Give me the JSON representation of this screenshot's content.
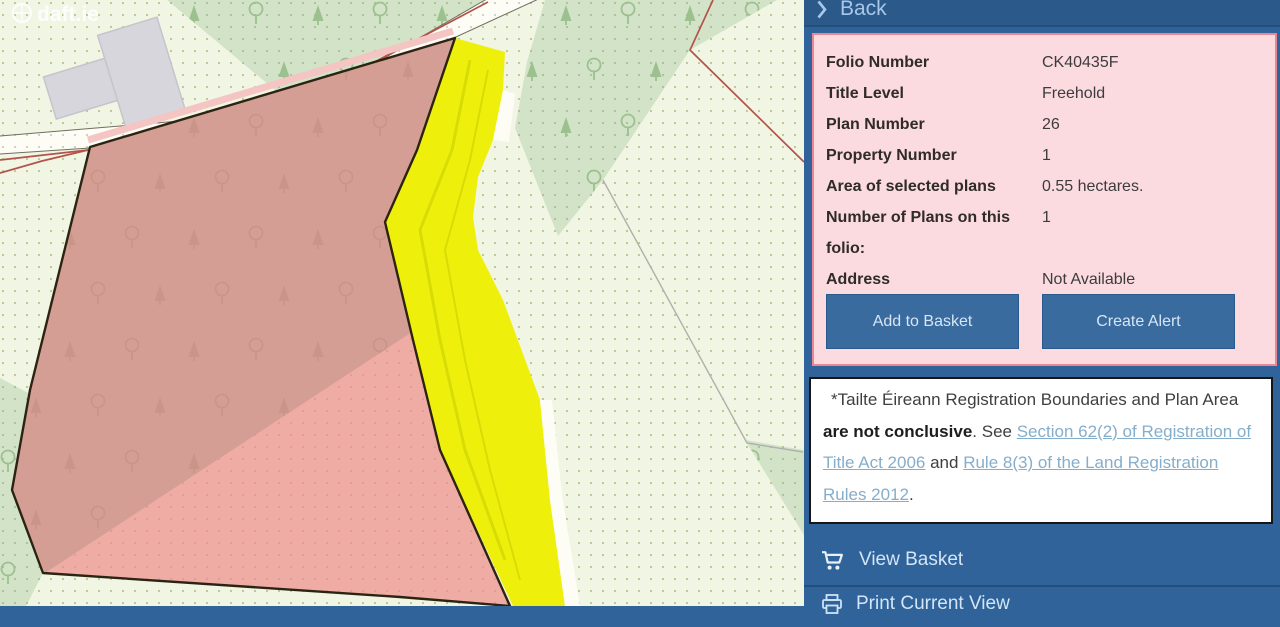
{
  "watermark": {
    "text": "daft.ie"
  },
  "panel": {
    "back_label": "Back",
    "info": {
      "rows": [
        {
          "label": "Folio Number",
          "value": "CK40435F"
        },
        {
          "label": "Title Level",
          "value": "Freehold"
        },
        {
          "label": "Plan Number",
          "value": "26"
        },
        {
          "label": "Property Number",
          "value": "1"
        },
        {
          "label": "Area of selected plans",
          "value": "0.55 hectares."
        },
        {
          "label": "Number of Plans on this folio:",
          "value": "1"
        },
        {
          "label": "Address",
          "value": "Not Available"
        }
      ],
      "buttons": [
        {
          "label": "Add to Basket"
        },
        {
          "label": "Create Alert"
        }
      ]
    },
    "disclaimer": {
      "segments": [
        {
          "text": "*Tailte Éireann Registration Boundaries and Plan Area ",
          "style": "normal"
        },
        {
          "text": "are not conclusive",
          "style": "bold"
        },
        {
          "text": ". See ",
          "style": "normal"
        },
        {
          "text": "Section 62(2) of Registration of Title Act 2006",
          "style": "link"
        },
        {
          "text": " and ",
          "style": "normal"
        },
        {
          "text": "Rule 8(3) of the Land Registration Rules 2012",
          "style": "link"
        },
        {
          "text": ".",
          "style": "normal"
        }
      ]
    },
    "actions": [
      {
        "label": "View Basket",
        "icon": "cart-icon"
      },
      {
        "label": "Print Current View",
        "icon": "printer-icon"
      }
    ]
  },
  "colors": {
    "panel_blue": "#2f6399",
    "back_bar_blue": "#2b5a8a",
    "button_blue": "#3a6b9e",
    "card_pink_bg": "#fbdbe0",
    "card_pink_border": "#ea8793",
    "link_blue": "#85aecb",
    "base_green": "#f1f5e3",
    "base_dot": "#bcc48e",
    "forest_green": "#d3e3c8",
    "forest_dot": "#aabf98",
    "tree_green": "#9cc18f",
    "road_white": "#fdfdf6",
    "road_dot": "#ccccc0",
    "road_edge": "#6f6f60",
    "boundary_red": "#b3534b",
    "gray_line": "#b0b0ab",
    "building_gray": "#d7d6dc",
    "plan_yellow": "#eef00c",
    "yellow_streak": "#d8dc04",
    "highlight_pink": "#efaca5",
    "highlight_pink_dot": "#e29a92",
    "highlight_pink_dark": "#d59e94",
    "pink_halo": "#f4c5c3",
    "tree_pink": "#c08b7e",
    "plan_border_black": "#2b2413"
  }
}
